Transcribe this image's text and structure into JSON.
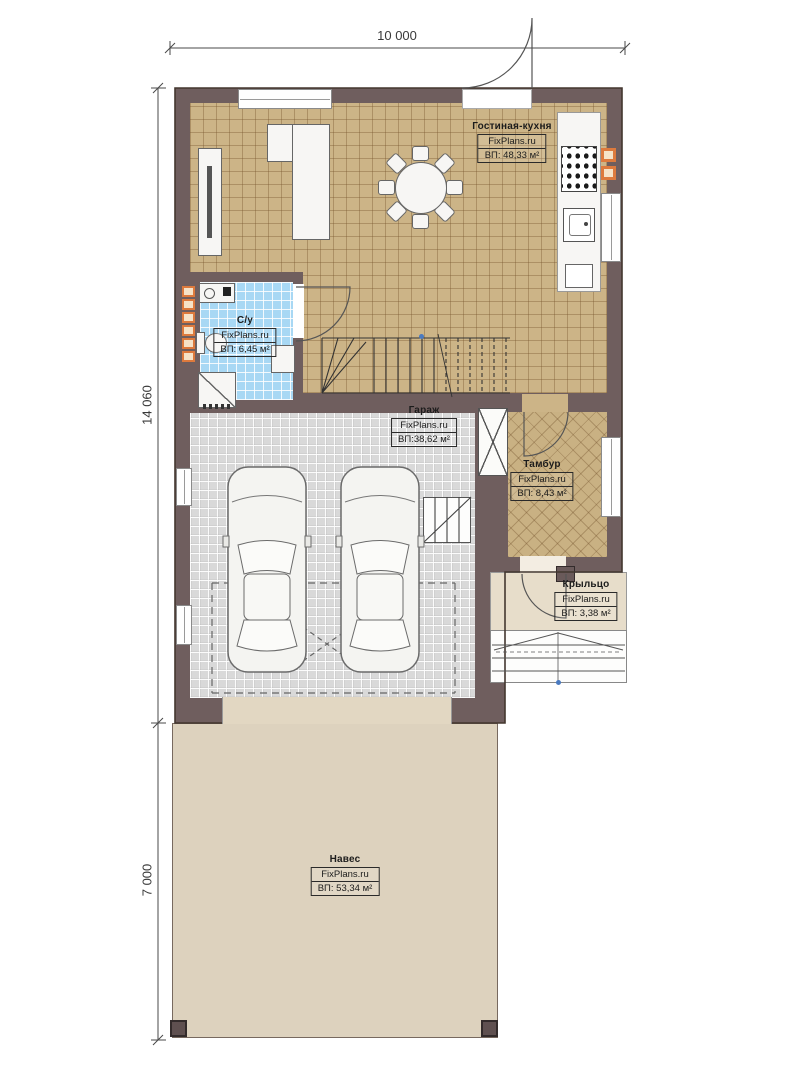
{
  "plan": {
    "title": "Floor plan first floor",
    "watermark": "FixPlans.ru",
    "dimensions": {
      "width_top": "10 000",
      "height_upper": "14 060",
      "height_lower": "7 000"
    },
    "rooms": [
      {
        "id": "living-kitchen",
        "name": "Гостиная-кухня",
        "brand": "FixPlans.ru",
        "area": "ВП: 48,33 м²"
      },
      {
        "id": "bathroom",
        "name": "С/у",
        "brand": "FixPlans.ru",
        "area": "ВП: 6,45 м²"
      },
      {
        "id": "garage",
        "name": "Гараж",
        "brand": "FixPlans.ru",
        "area": "ВП:38,62 м²"
      },
      {
        "id": "vestibule",
        "name": "Тамбур",
        "brand": "FixPlans.ru",
        "area": "ВП: 8,43 м²"
      },
      {
        "id": "porch",
        "name": "Крыльцо",
        "brand": "FixPlans.ru",
        "area": "ВП: 3,38 м²"
      },
      {
        "id": "canopy",
        "name": "Навес",
        "brand": "FixPlans.ru",
        "area": "ВП: 53,34 м²"
      }
    ],
    "colors": {
      "wall": "#6f5e5e",
      "floor_living": "#ccb487",
      "floor_bathroom": "#a8d8f4",
      "floor_garage": "#d9d9d9",
      "floor_vestibule": "#c9b183",
      "floor_porch": "#e7ddca",
      "floor_canopy": "#ddd2be",
      "accent_orange": "#dd7a3d"
    }
  }
}
